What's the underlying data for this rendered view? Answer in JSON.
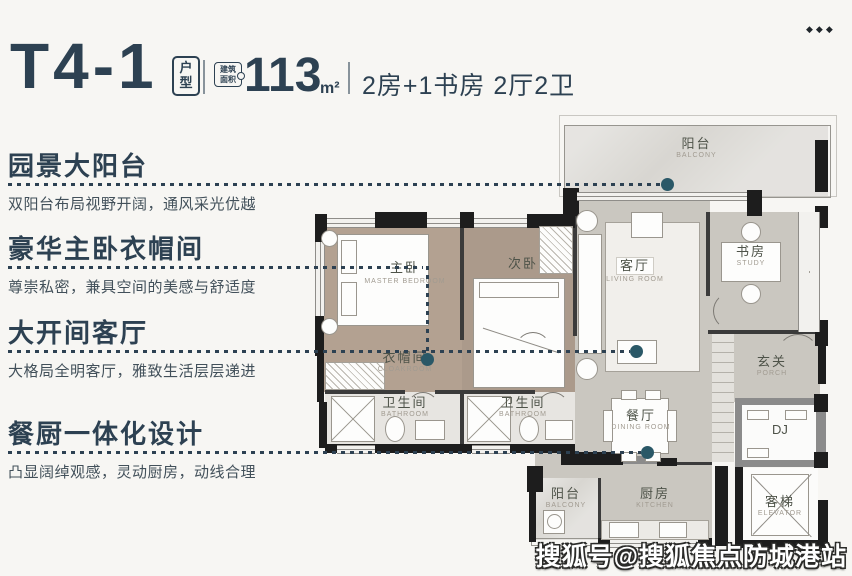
{
  "header": {
    "unit_code": "T4-1",
    "unit_type_badge_line1": "户",
    "unit_type_badge_line2": "型",
    "area_badge_line1": "建筑",
    "area_badge_line2": "面积",
    "area_value": "113",
    "area_unit": "m²",
    "layout_summary": "2房+1书房 2厅2卫"
  },
  "ornaments": {
    "more_dots": "◆◆◆"
  },
  "features": [
    {
      "title": "园景大阳台",
      "desc": "双阳台布局视野开阔，通风采光优越"
    },
    {
      "title": "豪华主卧衣帽间",
      "desc": "尊崇私密，兼具空间的美感与舒适度"
    },
    {
      "title": "大开间客厅",
      "desc": "大格局全明客厅，雅致生活层层递进"
    },
    {
      "title": "餐厨一体化设计",
      "desc": "凸显阔绰观感，灵动厨房，动线合理"
    }
  ],
  "rooms": {
    "balcony_top": {
      "zh": "阳台",
      "en": "BALCONY"
    },
    "master_bedroom": {
      "zh": "主卧",
      "en": "MASTER BEDROOM"
    },
    "second_bedroom": {
      "zh": "次卧",
      "en": ""
    },
    "living_room": {
      "zh": "客厅",
      "en": "LIVING ROOM"
    },
    "study": {
      "zh": "书房",
      "en": "STUDY"
    },
    "cloakroom": {
      "zh": "衣帽间",
      "en": "CLOAKROOM"
    },
    "porch": {
      "zh": "玄关",
      "en": "PORCH"
    },
    "bathroom1": {
      "zh": "卫生间",
      "en": "BATHROOM"
    },
    "bathroom2": {
      "zh": "卫生间",
      "en": "BATHROOM"
    },
    "dining_room": {
      "zh": "餐厅",
      "en": "DINING ROOM"
    },
    "dj": {
      "zh": "DJ",
      "en": ""
    },
    "balcony_bottom": {
      "zh": "阳台",
      "en": "BALCONY"
    },
    "kitchen": {
      "zh": "厨房",
      "en": "KITCHEN"
    },
    "elevator": {
      "zh": "客梯",
      "en": "ELEVATOR"
    }
  },
  "watermark": "搜狐号@搜狐焦点防城港站",
  "colors": {
    "accent": "#2d4152",
    "connector_dot": "#2a5867",
    "wall": "#1d1d1d",
    "wood_floor": "#b3a191",
    "concrete_floor": "#cac7c0",
    "balcony_floor": "#d8d6d1",
    "background": "#f7f6f3"
  }
}
